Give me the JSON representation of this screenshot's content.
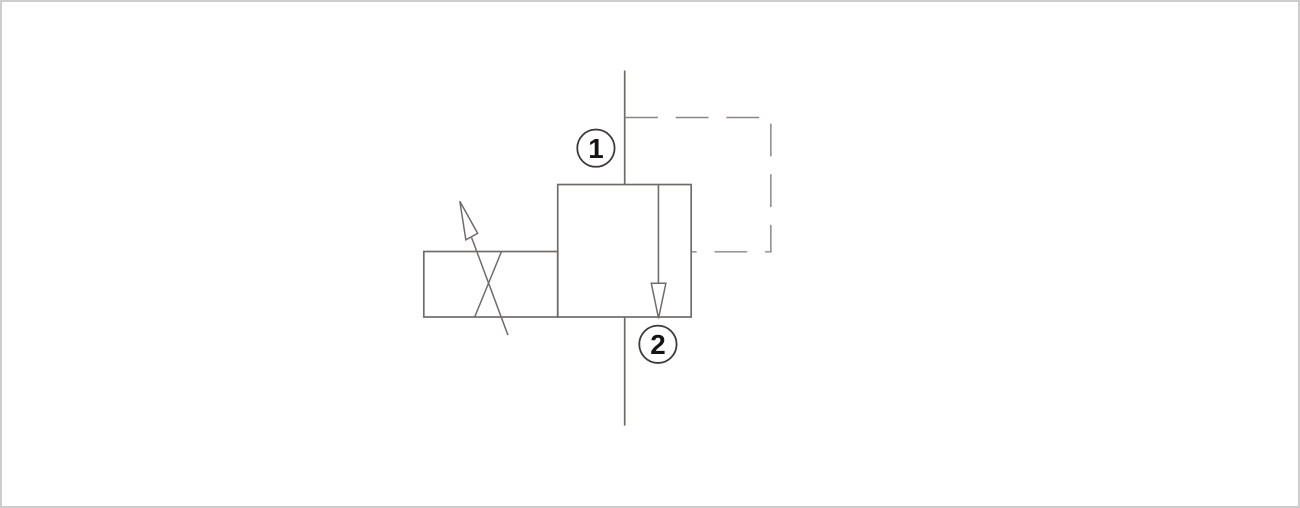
{
  "page": {
    "background": "#ffffff",
    "frame_border_color": "#cdcdcd"
  },
  "diagram": {
    "type": "hydraulic-valve-schematic",
    "symbol": "pilot-operated pressure valve cartridge symbol, normally-closed, adjustable",
    "ports": [
      {
        "label": "1"
      },
      {
        "label": "2"
      }
    ],
    "components": {
      "valve_body": "valve-body-box",
      "actuator": "adjustable-actuator-box",
      "flow_arrow": "downward-flow-arrow",
      "pilot_line": "dashed-pilot-line",
      "adjustment": "diagonal-adjustment-arrow",
      "port_1_line": "port-1-flow-line",
      "port_2_line": "port-2-flow-line"
    },
    "colors": {
      "line": "#706b68",
      "dashed_line": "#8b8784",
      "port_circle_stroke": "#3c3a38",
      "port_label": "#141414",
      "background": "#ffffff"
    }
  }
}
